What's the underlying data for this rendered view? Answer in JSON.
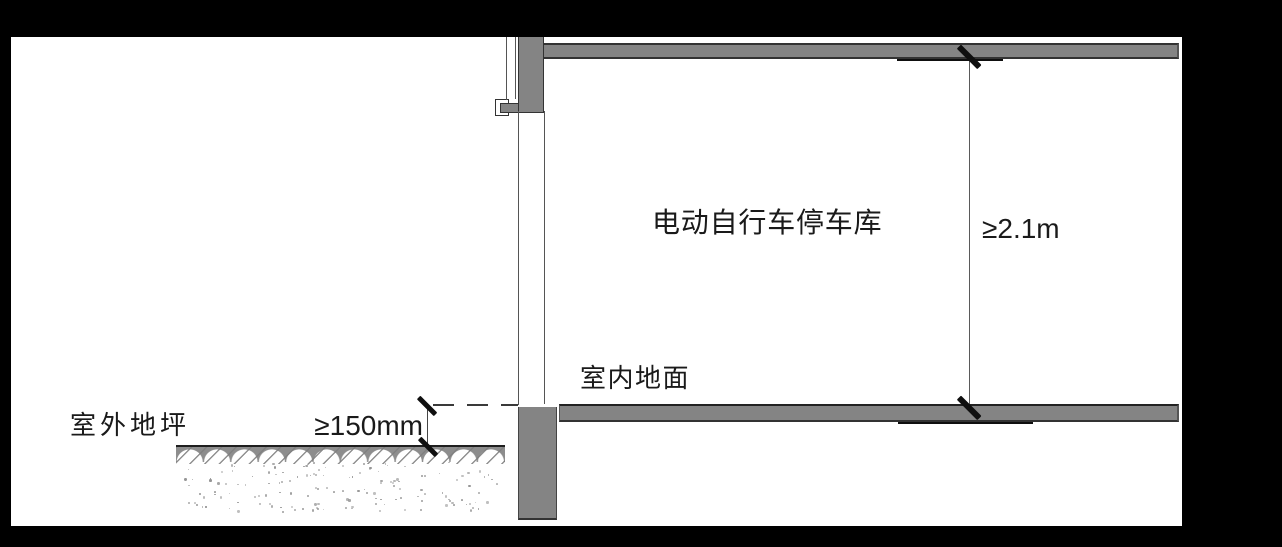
{
  "colors": {
    "frame_black": "#000000",
    "paper_white": "#ffffff",
    "concrete_gray": "#848484",
    "earth_gray": "#8d8d8d",
    "outline_dark": "#333333",
    "tick_black": "#0f0f0f",
    "text_dark": "#1a1a1a"
  },
  "drawing": {
    "room_label": "电动自行车停车库",
    "clear_height_dimension": "≥2.1m",
    "indoor_floor_label": "室内地面",
    "outdoor_ground_label": "室外地坪",
    "floor_raise_dimension": "≥150mm"
  }
}
